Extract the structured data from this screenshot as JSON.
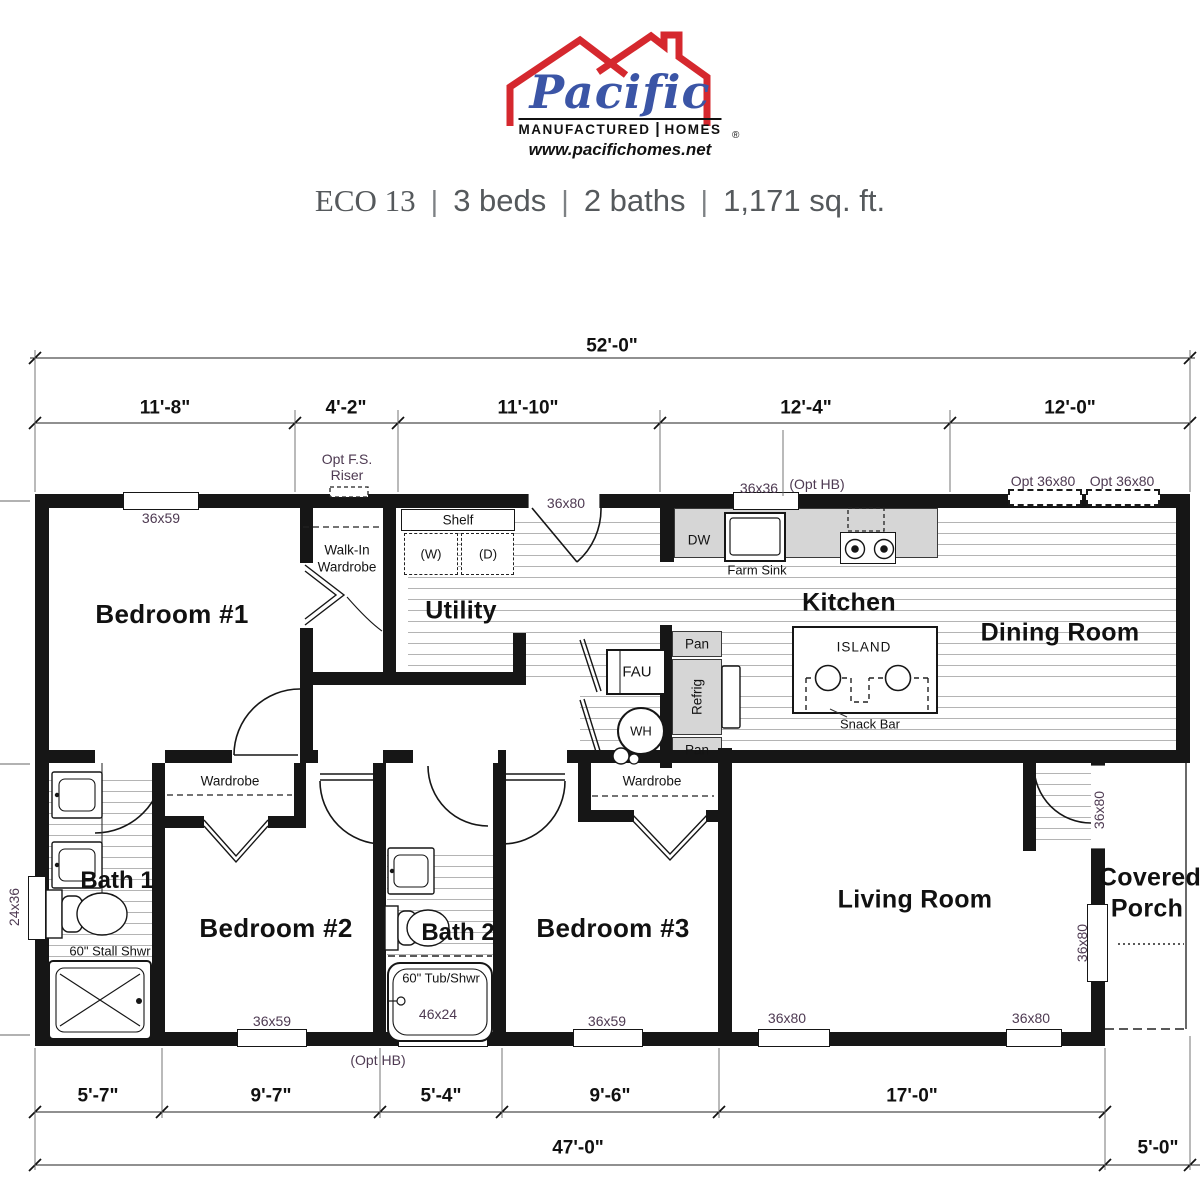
{
  "brand": {
    "name": "Pacific",
    "sub1": "MANUFACTURED",
    "sub2": "HOMES",
    "reg": "®",
    "url": "www.pacifichomes.net"
  },
  "title": {
    "model": "ECO 13",
    "sep": "|",
    "beds": "3 beds",
    "baths": "2 baths",
    "area": "1,171 sq. ft."
  },
  "dims": {
    "overall_top": "52'-0\"",
    "top": [
      "11'-8\"",
      "4'-2\"",
      "11'-10\"",
      "12'-4\"",
      "12'-0\""
    ],
    "bottom": [
      "5'-7\"",
      "9'-7\"",
      "5'-4\"",
      "9'-6\"",
      "17'-0\""
    ],
    "bottom_main": "47'-0\"",
    "bottom_porch": "5'-0\""
  },
  "rooms": {
    "bed1": "Bedroom #1",
    "bed2": "Bedroom #2",
    "bed3": "Bedroom #3",
    "bath1": "Bath 1",
    "bath2": "Bath 2",
    "utility": "Utility",
    "kitchen": "Kitchen",
    "dining": "Dining Room",
    "living": "Living Room",
    "porch_line1": "Covered",
    "porch_line2": "Porch"
  },
  "fixtures": {
    "walkin_line1": "Walk-In",
    "walkin_line2": "Wardrobe",
    "wardrobe2": "Wardrobe",
    "wardrobe3": "Wardrobe",
    "shelf": "Shelf",
    "washer": "(W)",
    "dryer": "(D)",
    "dw": "DW",
    "farm_sink": "Farm Sink",
    "island": "ISLAND",
    "snack_bar": "Snack Bar",
    "pan1": "Pan",
    "refrig": "Refrig",
    "pan2": "Pan",
    "fau": "FAU",
    "wh": "WH",
    "stall_shower": "60\" Stall Shwr",
    "tub_shower": "60\" Tub/Shwr"
  },
  "openings": {
    "riser1": "Opt F.S.",
    "riser2": "Riser",
    "bed1_win": "36x59",
    "utility_door": "36x80",
    "kitchen_win": "36x36",
    "opt_hb_top": "(Opt HB)",
    "opt_door1": "Opt 36x80",
    "opt_door2": "Opt 36x80",
    "bath1_win": "24x36",
    "bed2_win": "36x59",
    "bath2_win": "46x24",
    "bed3_win": "36x59",
    "living_win1": "36x80",
    "living_win2": "36x80",
    "entry_door": "36x80",
    "living_side_win": "36x80",
    "opt_hb_bottom": "(Opt HB)"
  }
}
